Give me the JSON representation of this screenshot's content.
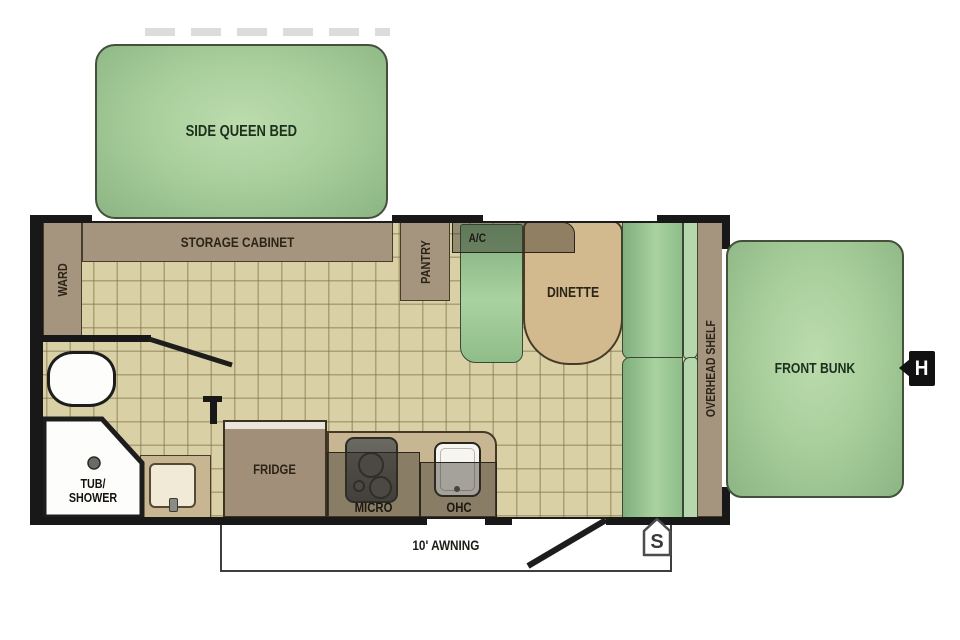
{
  "title": "Travel trailer floorplan",
  "labels": {
    "side_queen_bed": "SIDE QUEEN BED",
    "storage_cabinet": "STORAGE CABINET",
    "ward": "WARD",
    "pantry": "PANTRY",
    "ac": "A/C",
    "dinette": "DINETTE",
    "overhead_shelf": "OVERHEAD SHELF",
    "front_bunk": "FRONT BUNK",
    "tub_shower_line1": "TUB/",
    "tub_shower_line2": "SHOWER",
    "fridge": "FRIDGE",
    "micro": "MICRO",
    "ohc": "OHC",
    "awning": "10' AWNING",
    "marker_s": "S",
    "marker_h": "H"
  },
  "colors": {
    "bed_green": "#a9cf9c",
    "bench_green": "#93c28d",
    "backrest_green": "#b6d7ab",
    "floor_tan": "#d9d0a6",
    "cabinet_tan": "#a5947e",
    "counter_tan": "#c8b591",
    "table_tan": "#d2b98e",
    "fridge_brown": "#a28f7a",
    "wall_black": "#181818",
    "label_dark": "#2b2417"
  }
}
